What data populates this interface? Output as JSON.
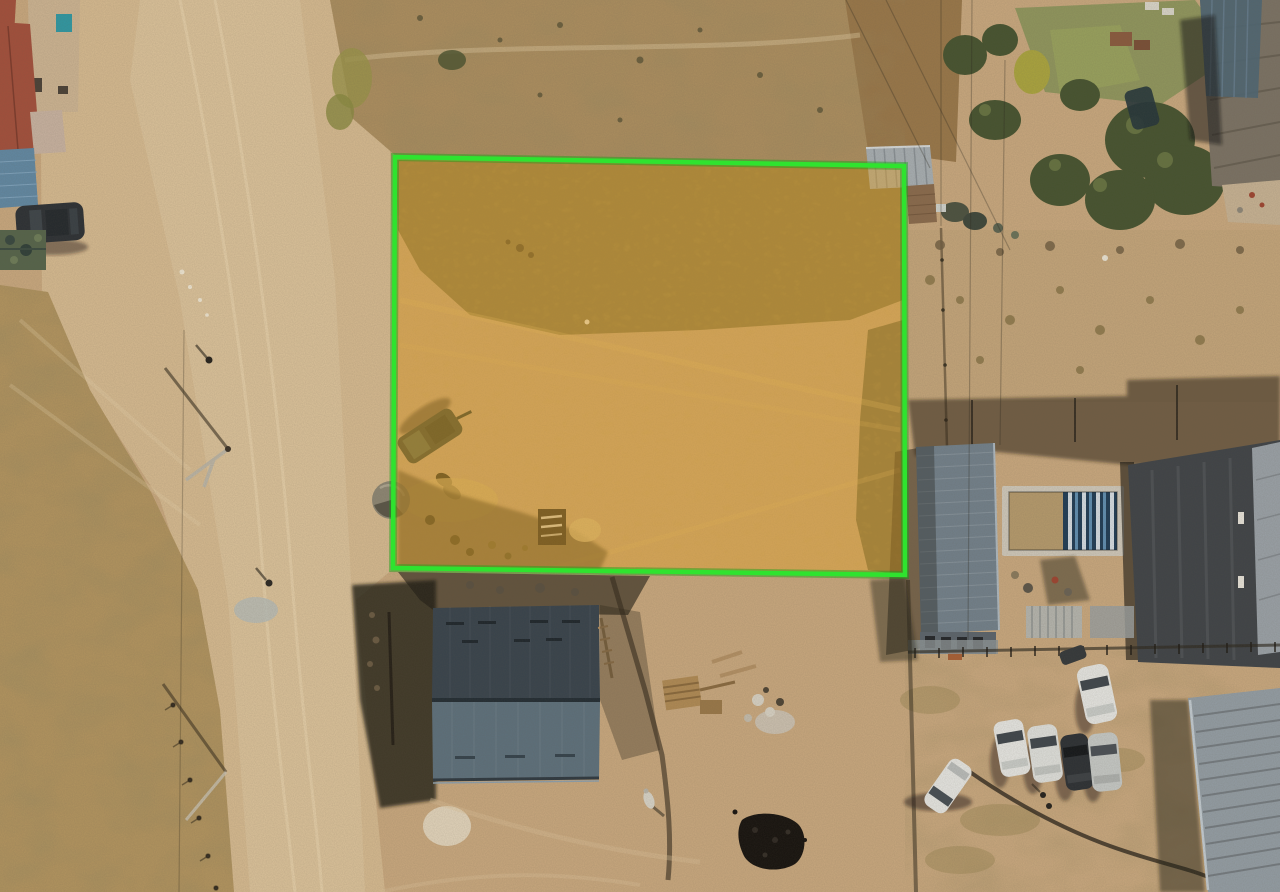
{
  "image": {
    "kind": "aerial-drone-photo",
    "width": 1280,
    "height": 892
  },
  "palette": {
    "sand": "#c9a87e",
    "road": "#d6ba90",
    "road_highlight": "#e0c8a2",
    "grass_field": "#b2945f",
    "scrub_top": "#ac8e5f",
    "bank_brown": "#997749",
    "veg_in_plot": "#867748",
    "veg_strip_dark": "#6a6440",
    "roof_red": "#a34f3b",
    "roof_blue": "#6188a3",
    "roof_slate_upper": "#38434c",
    "roof_slate_lower": "#5d707c",
    "roof_long_gray": "#72808b",
    "roof_corrugated_br": "#939da4",
    "roof_big_tr": "#7b7264",
    "roof_teal_tr": "#4e6673",
    "pool_water": "#1f3c55",
    "pool_deck": "#cfc8ba",
    "pool_sand": "#b59a6c",
    "tree_green": "#46532f",
    "grass_green": "#89945a",
    "car_white": "#e6e6e2",
    "car_dark": "#2c3034",
    "car_silver": "#c6c9c6",
    "camo_green": "#55644a",
    "coal_black": "#16120e",
    "shadow": "rgba(35,30,21,0.55)"
  },
  "annotation": {
    "plot_highlight": {
      "points": "395,157 904,166 905,575 393,568",
      "fill": "#dfa02a",
      "fill_opacity": "0.44",
      "stroke": "#2fe32f",
      "stroke_width": "4.5",
      "under_stroke": "#17a017",
      "under_stroke_width": "8",
      "under_stroke_opacity": "0.45"
    }
  },
  "scene": {
    "objects": [
      "highlighted-land-plot",
      "dirt-road",
      "dry-grass-field",
      "scrub-field",
      "red-roof-house",
      "blue-roof-shed",
      "parked-suv",
      "camo-crates",
      "fallen-pole",
      "pedestrians",
      "metal-shed",
      "trees",
      "lawn-patches",
      "large-roof-building",
      "long-gray-roof-house",
      "swimming-pool",
      "construction-building",
      "slate-roof-house",
      "house-shadow",
      "wood-pallets",
      "coal-pile",
      "goat",
      "parked-cars",
      "corrugated-roof-building",
      "trailer-in-plot",
      "storage-crate-in-plot",
      "dome-tank",
      "power-lines",
      "fences"
    ]
  }
}
